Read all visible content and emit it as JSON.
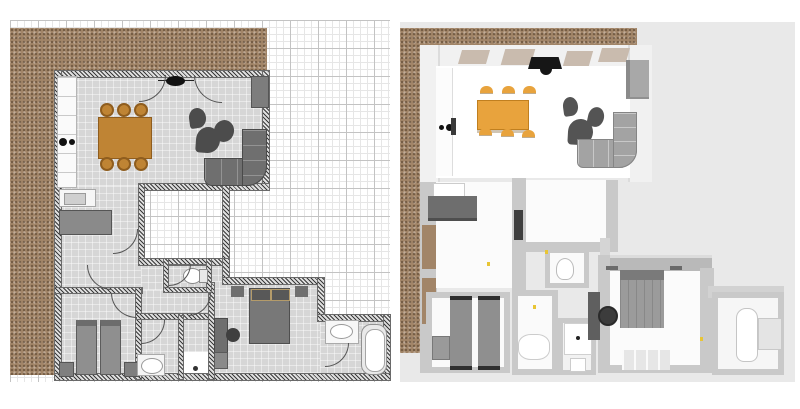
{
  "app": {
    "type": "floor-plan-viewer",
    "panels": [
      {
        "id": "plan-2d",
        "label": "2D floor plan with grid paper and terrace"
      },
      {
        "id": "plan-3d",
        "label": "3D aerial view of same apartment"
      }
    ]
  },
  "colors": {
    "terrace": "#a28568",
    "gridf": "#e6e6e6",
    "gridh": "#c3c3c3",
    "floor2d": "#d6d6d6",
    "hatch": "#3a3a3a",
    "wood2d": "#bf8434",
    "wood3d": "#e8a33d",
    "dark": "#4c4c4c",
    "sofa2d": "#6f6f6f",
    "sofa3d": "#a3a3a3",
    "bed": "#8f8f8f",
    "bg3d": "#e9e9e9",
    "wall3d": "#c9c9c9",
    "switch": "#e8c535"
  },
  "plan2d": {
    "rooms": [
      "living-room",
      "kitchen",
      "hallway",
      "courtyard",
      "toilet",
      "bedroom-left",
      "shower-room",
      "closet",
      "master-bedroom",
      "bathroom"
    ],
    "furniture": [
      "kitchen-counter",
      "stove",
      "kitchen-sink",
      "sideboard",
      "dining-table",
      "dining-chairs-x6",
      "ceiling-lamp",
      "wardrobe",
      "pouf-chairs-x3",
      "corner-sofa",
      "single-bed-x2",
      "nightstand-x4",
      "double-bed",
      "desk",
      "desk-chair",
      "washbasin",
      "wc",
      "bath-sink",
      "bathtub"
    ]
  },
  "plan3d": {
    "rooms": [
      "living-room",
      "kitchen",
      "hallway",
      "courtyard",
      "toilet",
      "bedroom-left",
      "shower-room",
      "master-bedroom",
      "bathroom"
    ],
    "furniture": [
      "windows-x4",
      "tv",
      "kitchen-counter",
      "dining-table",
      "dining-chairs-x6",
      "pouf-chairs-x3",
      "corner-sofa",
      "wardrobe",
      "sideboard",
      "kitchen-sink",
      "single-bed-x2",
      "double-bed",
      "desk",
      "desk-chair",
      "washbasin",
      "shower-tray",
      "wc",
      "bathtub",
      "rug",
      "light-switches"
    ]
  }
}
